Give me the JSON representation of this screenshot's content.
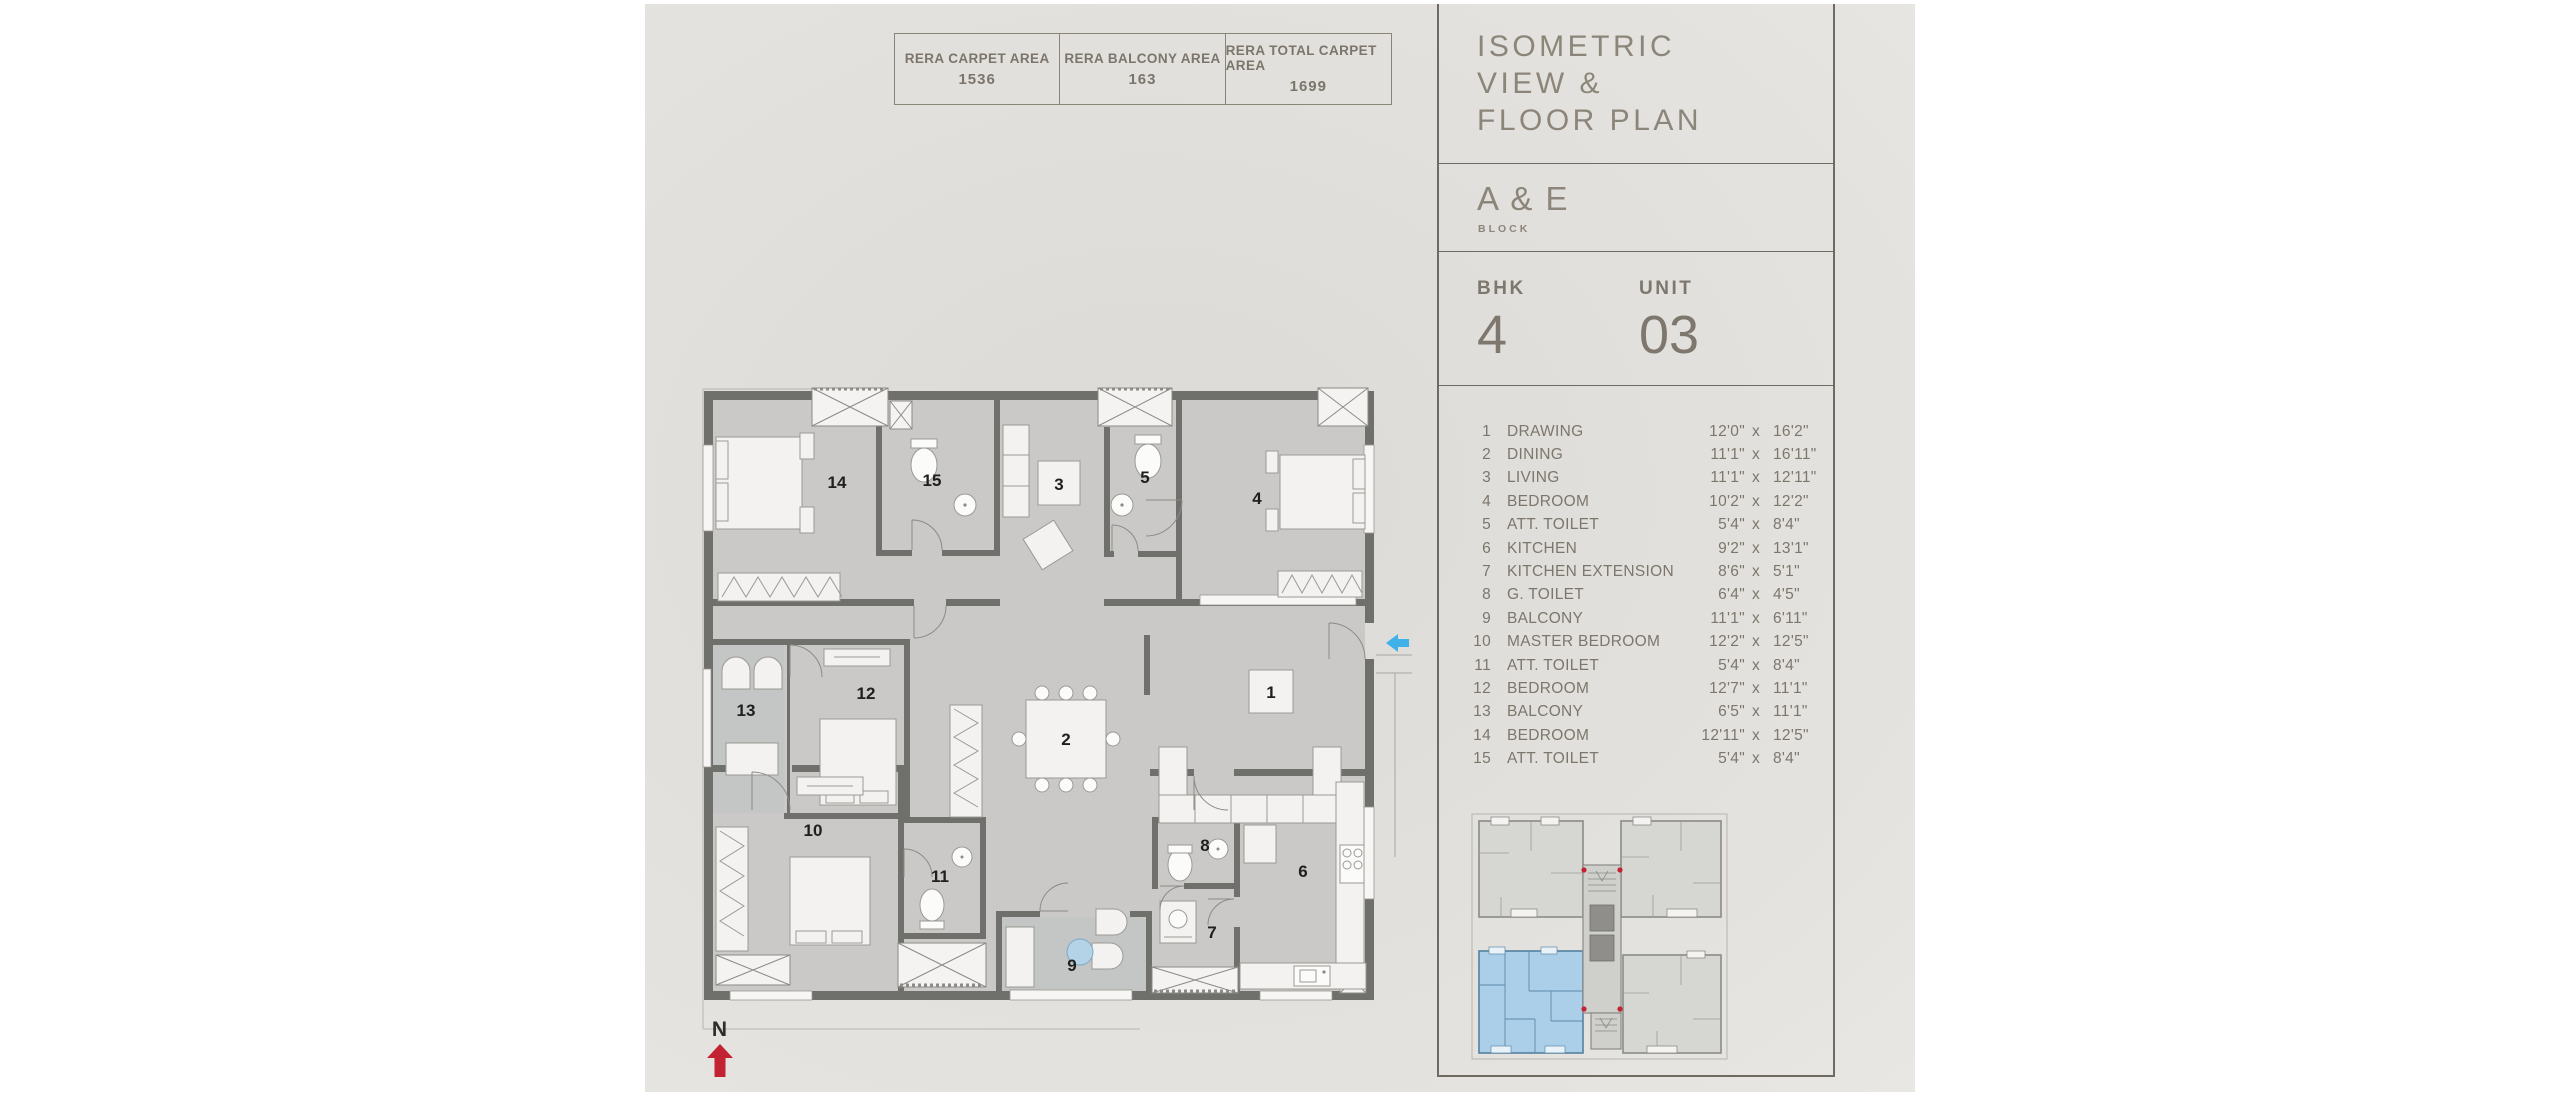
{
  "area_summary": {
    "cells": [
      {
        "label": "RERA CARPET AREA",
        "value": "1536"
      },
      {
        "label": "RERA BALCONY AREA",
        "value": "163"
      },
      {
        "label": "RERA TOTAL CARPET AREA",
        "value": "1699"
      }
    ]
  },
  "panel": {
    "title_lines": [
      "ISOMETRIC",
      "VIEW &",
      "FLOOR PLAN"
    ],
    "block_name": "A & E",
    "block_label": "BLOCK",
    "bhk_label": "BHK",
    "bhk_value": "4",
    "unit_label": "UNIT",
    "unit_value": "03"
  },
  "dimensions": {
    "separator": "x",
    "rows": [
      {
        "no": "1",
        "name": "DRAWING",
        "w": "12'0\"",
        "h": "16'2\""
      },
      {
        "no": "2",
        "name": "DINING",
        "w": "11'1\"",
        "h": "16'11\""
      },
      {
        "no": "3",
        "name": "LIVING",
        "w": "11'1\"",
        "h": "12'11\""
      },
      {
        "no": "4",
        "name": "BEDROOM",
        "w": "10'2\"",
        "h": "12'2\""
      },
      {
        "no": "5",
        "name": "ATT. TOILET",
        "w": "5'4\"",
        "h": "8'4\""
      },
      {
        "no": "6",
        "name": "KITCHEN",
        "w": "9'2\"",
        "h": "13'1\""
      },
      {
        "no": "7",
        "name": "KITCHEN EXTENSION",
        "w": "8'6\"",
        "h": "5'1\""
      },
      {
        "no": "8",
        "name": "G. TOILET",
        "w": "6'4\"",
        "h": "4'5\""
      },
      {
        "no": "9",
        "name": "BALCONY",
        "w": "11'1\"",
        "h": "6'11\""
      },
      {
        "no": "10",
        "name": "MASTER BEDROOM",
        "w": "12'2\"",
        "h": "12'5\""
      },
      {
        "no": "11",
        "name": "ATT. TOILET",
        "w": "5'4\"",
        "h": "8'4\""
      },
      {
        "no": "12",
        "name": "BEDROOM",
        "w": "12'7\"",
        "h": "11'1\""
      },
      {
        "no": "13",
        "name": "BALCONY",
        "w": "6'5\"",
        "h": "11'1\""
      },
      {
        "no": "14",
        "name": "BEDROOM",
        "w": "12'11\"",
        "h": "12'5\""
      },
      {
        "no": "15",
        "name": "ATT. TOILET",
        "w": "5'4\"",
        "h": "8'4\""
      }
    ]
  },
  "plan": {
    "north_label": "N",
    "room_numbers": [
      "1",
      "2",
      "3",
      "4",
      "5",
      "6",
      "7",
      "8",
      "9",
      "10",
      "11",
      "12",
      "13",
      "14",
      "15"
    ]
  },
  "colors": {
    "accent_entry_arrow": "#41b1e9",
    "accent_north_arrow": "#c32231",
    "keyplan_highlight": "#abcfe9",
    "line": "#6f6a62",
    "text_gray": "#7c766c"
  }
}
